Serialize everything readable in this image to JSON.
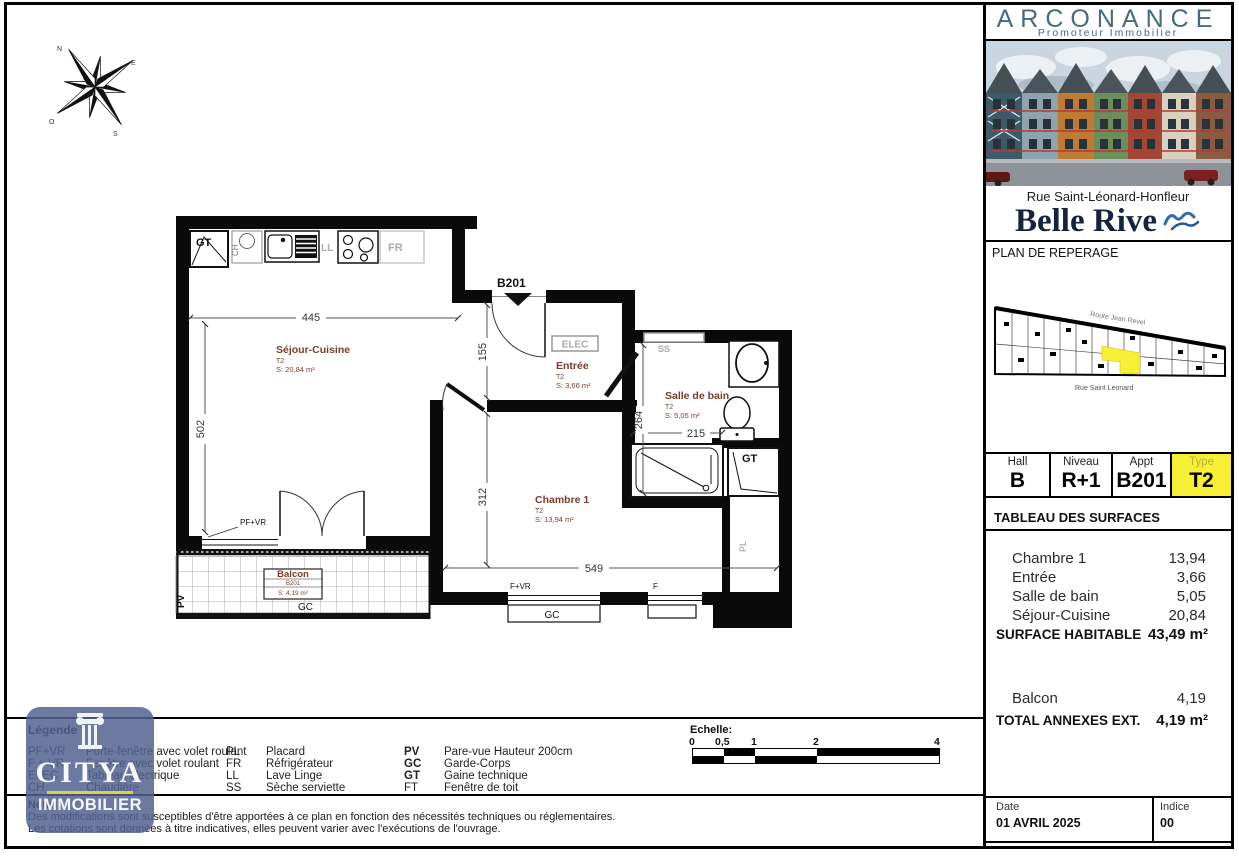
{
  "compass": {
    "n": "N",
    "e": "E",
    "s": "S",
    "o": "O"
  },
  "colors": {
    "highlight_yellow": "#f7ef35",
    "room_label": "#7b3b2a",
    "brand_teal": "#466b7b",
    "navy": "#16233f",
    "wave_blue": "#2e6cae"
  },
  "plan": {
    "unit_door_label": "B201",
    "rooms": {
      "sejour": {
        "name": "Séjour-Cuisine",
        "type": "T2",
        "surface": "S: 20,84 m²"
      },
      "entree": {
        "name": "Entrée",
        "type": "T2",
        "surface": "S: 3,66 m²"
      },
      "bain": {
        "name": "Salle de bain",
        "type": "T2",
        "surface": "S: 5,05 m²"
      },
      "chambre": {
        "name": "Chambre 1",
        "type": "T2",
        "surface": "S: 13,94 m²"
      },
      "balcon": {
        "name": "Balcon",
        "unit": "B201",
        "surface": "S: 4,19 m²"
      }
    },
    "dims": {
      "w445": "445",
      "h502": "502",
      "h155": "155",
      "h264": "264",
      "w215": "215",
      "h312": "312",
      "w549": "549"
    },
    "tags": {
      "gt_top": "GT",
      "ch": "CH",
      "ll": "LL",
      "fr": "FR",
      "elec": "ELEC",
      "ss": "SS",
      "gt_bath": "GT",
      "pl": "PL",
      "pv": "PV",
      "gc_balcon": "GC",
      "gc_fenetre": "GC",
      "pfvr": "PF+VR",
      "fvr": "F+VR",
      "f": "F"
    }
  },
  "sidebar": {
    "brand": {
      "name": "ARCONANCE",
      "tagline": "Promoteur Immobilier"
    },
    "address": "Rue Saint-Léonard-Honfleur",
    "project": "Belle Rive",
    "section_title": "PLAN DE REPERAGE",
    "keyplan": {
      "street_top": "Route Jean Revel",
      "street_bottom": "Rue Saint Leonard"
    },
    "unit": {
      "hall_label": "Hall",
      "hall": "B",
      "niveau_label": "Niveau",
      "niveau": "R+1",
      "appt_label": "Appt",
      "appt": "B201",
      "type_label": "Type",
      "type": "T2"
    },
    "surfaces": {
      "title": "TABLEAU DES SURFACES",
      "rows": [
        {
          "label": "Chambre 1",
          "value": "13,94"
        },
        {
          "label": "Entrée",
          "value": "3,66"
        },
        {
          "label": "Salle de bain",
          "value": "5,05"
        },
        {
          "label": "Séjour-Cuisine",
          "value": "20,84"
        }
      ],
      "total_label": "SURFACE HABITABLE",
      "total_value": "43,49 m²",
      "annex_rows": [
        {
          "label": "Balcon",
          "value": "4,19"
        }
      ],
      "annex_total_label": "TOTAL ANNEXES EXT.",
      "annex_total_value": "4,19 m²"
    },
    "meta": {
      "date_label": "Date",
      "date_value": "01 AVRIL 2025",
      "indice_label": "Indice",
      "indice_value": "00"
    }
  },
  "legend": {
    "title": "Légende",
    "col1": [
      {
        "abbr": "PF+VR",
        "label": "Porte-fenêtre avec volet roulant"
      },
      {
        "abbr": "F + VR",
        "label": "Fenêtre avec volet roulant"
      },
      {
        "abbr": "ELEC",
        "label": "Tableau électrique"
      },
      {
        "abbr": "CH",
        "label": "Chaudière"
      }
    ],
    "col2": [
      {
        "abbr": "PL",
        "label": "Placard"
      },
      {
        "abbr": "FR",
        "label": "Réfrigérateur"
      },
      {
        "abbr": "LL",
        "label": "Lave Linge"
      },
      {
        "abbr": "SS",
        "label": "Sèche serviette"
      }
    ],
    "col3": [
      {
        "abbr": "PV",
        "label": "Pare-vue Hauteur 200cm"
      },
      {
        "abbr": "GC",
        "label": "Garde-Corps"
      },
      {
        "abbr": "GT",
        "label": "Gaine technique"
      },
      {
        "abbr": "FT",
        "label": "Fenêtre de toit"
      }
    ]
  },
  "scalebar": {
    "title": "Echelle:",
    "ticks": [
      "0",
      "0,5",
      "1",
      "2",
      "4"
    ]
  },
  "nota": {
    "title": "Nota",
    "line1": "Des modifications sont susceptibles d'être apportées à ce plan en fonction des nécessités techniques ou réglementaires.",
    "line2": "Les cotations sont données à titre indicatives, elles peuvent varier avec l'exécutions de l'ouvrage."
  },
  "watermark": {
    "name": "CITYA",
    "sub": "IMMOBILIER"
  }
}
